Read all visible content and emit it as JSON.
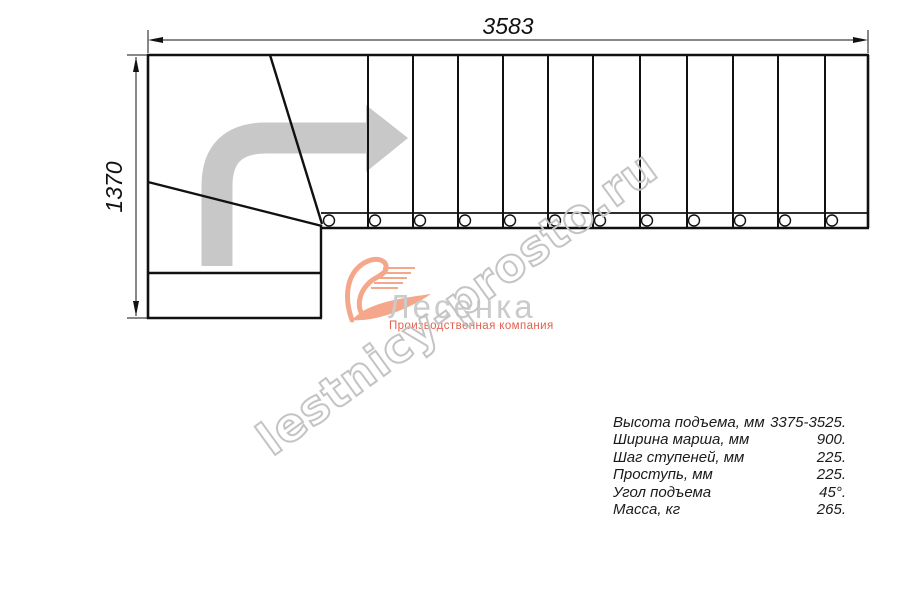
{
  "drawing": {
    "top_dimension_label": "3583",
    "left_dimension_label": "1370",
    "treads_count": 12,
    "balusters_count": 12
  },
  "watermark": {
    "text": "lestnicy-prosto.ru",
    "color": "#c4c4c4"
  },
  "logo": {
    "brand": "Лесенка",
    "subtitle": "Производственная компания",
    "brand_color": "#cbcbcb",
    "subtitle_color": "#e2604e",
    "swoosh_color": "#f5a78c",
    "swoosh_icon": "swoosh-wing-icon"
  },
  "specs": {
    "rows": [
      {
        "label": "Высота подъема, мм",
        "value": "3375-3525."
      },
      {
        "label": "Ширина марша, мм",
        "value": "900."
      },
      {
        "label": "Шаг ступеней, мм",
        "value": "225."
      },
      {
        "label": "Проступь, мм",
        "value": "225."
      },
      {
        "label": "Угол подъема",
        "value": "45°."
      },
      {
        "label": "Масса, кг",
        "value": "265."
      }
    ]
  },
  "colors": {
    "line": "#111111",
    "dimension": "#111111",
    "arrow_gray": "#c8c8c8",
    "watermark_gray": "#c4c4c4"
  }
}
